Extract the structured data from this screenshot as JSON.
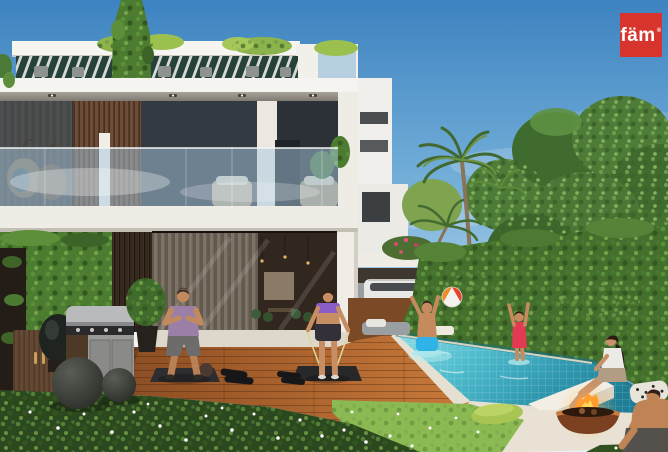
{
  "window": {
    "width": 668,
    "height": 452
  },
  "logo": {
    "text": "fäm",
    "mark": "®",
    "background_color": "#d6342c",
    "text_color": "#ffffff"
  },
  "scene": {
    "kind": "real-estate architectural render",
    "subject": "Modern white two-storey townhouse with rooftop pergola terrace, backyard swimming pool, outdoor gym deck, BBQ kitchen and fire bowl lounge",
    "time_of_day": "daytime, clear blue sky",
    "people": [
      {
        "role": "man-exercising",
        "clothing": "mauve tank top, grey shorts",
        "location": "wood deck, on black mat"
      },
      {
        "role": "woman-resistance-band",
        "clothing": "purple sports bra, black shorts",
        "location": "wood deck, on black mat"
      },
      {
        "role": "boy-in-pool",
        "clothing": "blue swim trunks",
        "activity": "playing with beach ball"
      },
      {
        "role": "girl-in-pool",
        "clothing": "red swimsuit",
        "activity": "catching beach ball"
      },
      {
        "role": "woman-sitting",
        "clothing": "white top, beige shorts",
        "location": "white pool ledge near fire bowl"
      },
      {
        "role": "man-sitting-corner",
        "clothing": "grey shorts",
        "location": "bottom right patio"
      }
    ],
    "objects": [
      "rooftop-pergola",
      "green-vertical-garden",
      "glass-balustrade",
      "egg-chairs",
      "wicker-armchairs",
      "timber-slat-column",
      "floor-to-ceiling-glazing",
      "bbq-grill",
      "kamado-grill",
      "exercise-balls",
      "dumbbells",
      "yoga-mats",
      "swimming-pool",
      "beach-ball",
      "sun-daybed",
      "fire-bowl",
      "green-cushion",
      "patterned-cushion",
      "carport-with-cars",
      "palm-trees",
      "hedge-wall",
      "flower-bed-with-daisies"
    ],
    "palette": {
      "sky_top": "#3d83c0",
      "sky_low": "#d7e8f3",
      "facade_white": "#f5f3ef",
      "timber": "#6e4c38",
      "pool_water": "#4fbccd",
      "hedge_green": "#44702e",
      "deck_wood": "#b06a33",
      "lawn": "#8cba52",
      "fire_orange": "#ff9d2e",
      "logo_red": "#d6342c"
    }
  }
}
